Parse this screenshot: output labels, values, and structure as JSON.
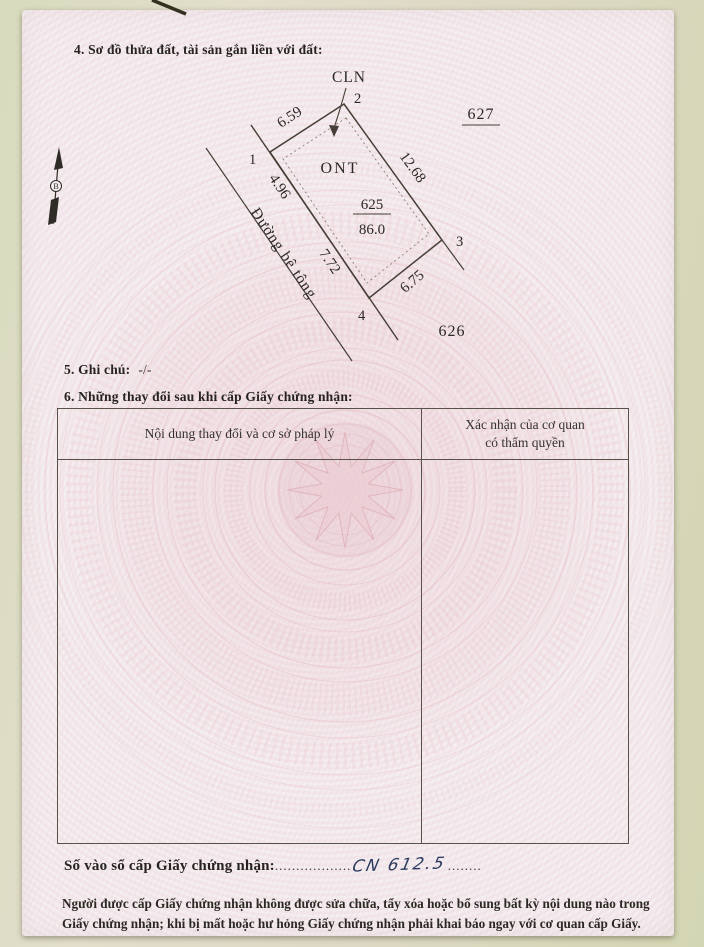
{
  "page": {
    "section4_title": "4. Sơ đồ thửa đất, tài sản gắn liền với đất:",
    "section5_label": "5. Ghi chú:",
    "section5_value": "-/-",
    "section6_title": "6. Những thay đổi sau khi cấp Giấy chứng nhận:"
  },
  "diagram": {
    "land_use_outside": "CLN",
    "land_use_inside": "ONT",
    "parcel_number": "625",
    "parcel_area": "86.0",
    "adjacent_parcel_right": "627",
    "adjacent_parcel_bottom": "626",
    "road_label": "Đường bê tông",
    "north_label": "B",
    "vertex_1": "1",
    "vertex_2": "2",
    "vertex_3": "3",
    "vertex_4": "4",
    "len_12": "6.59",
    "len_23": "12.68",
    "len_34": "6.75",
    "len_41a": "4.96",
    "len_41b": "7.72"
  },
  "table": {
    "col1_header": "Nội dung thay đổi và cơ sở pháp lý",
    "col2_header_line1": "Xác nhận của cơ quan",
    "col2_header_line2": "có thẩm quyền"
  },
  "footer": {
    "register_label": "Số vào sổ cấp Giấy chứng nhận:",
    "dots_before": "..................",
    "register_value": "CN 612.5",
    "dots_after": "........",
    "notice_line1": "Người được cấp Giấy chứng nhận không được sửa chữa, tẩy xóa hoặc bổ sung bất kỳ nội dung nào trong",
    "notice_line2": "Giấy chứng nhận; khi bị mất hoặc hư hỏng Giấy chứng nhận phải khai báo ngay với cơ quan cấp Giấy."
  },
  "colors": {
    "paper": "#f5eef0",
    "guilloche_pink": "#e9c6cd",
    "line": "#453f37",
    "ink_blue": "#2b3a5e",
    "background": "#dbd9bf"
  }
}
